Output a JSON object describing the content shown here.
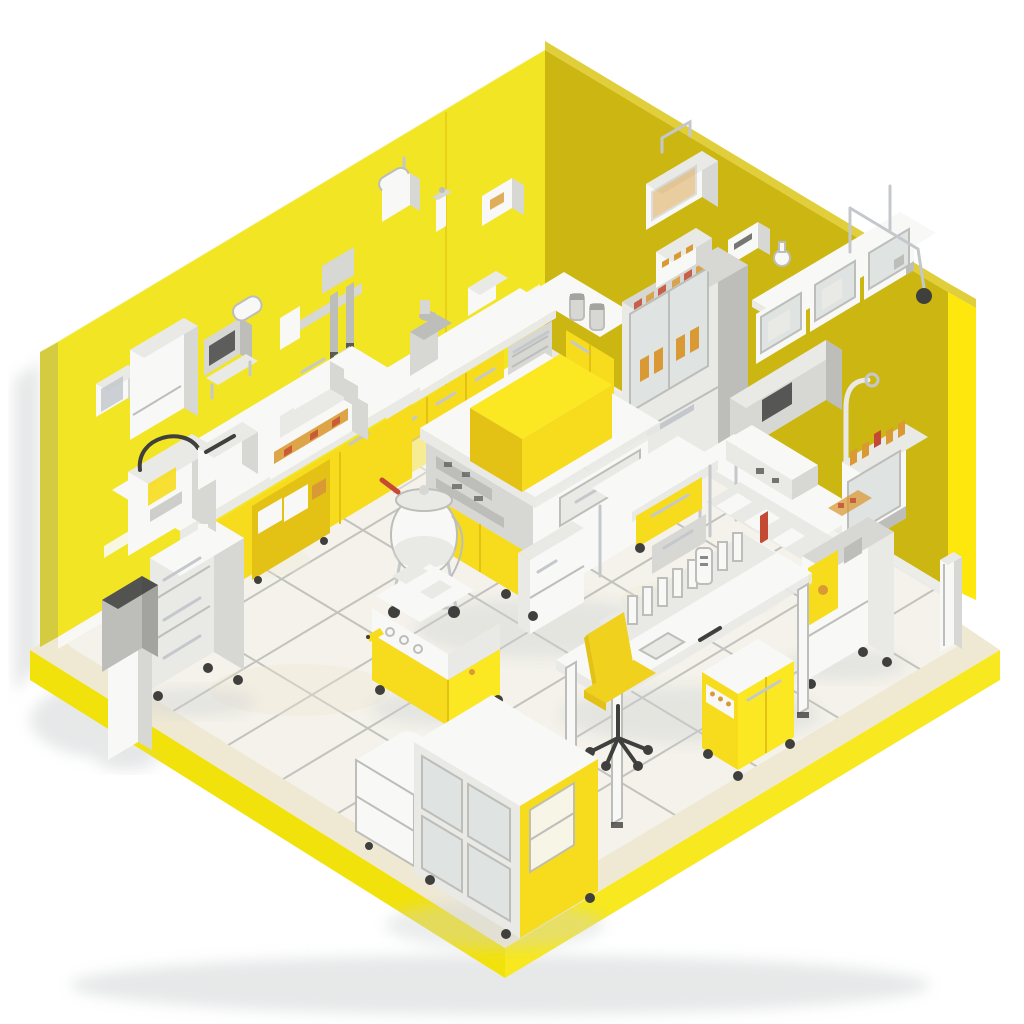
{
  "scene": {
    "type": "isometric-room-illustration",
    "subject": "laboratory",
    "description": "Isometric 3D illustration of a laboratory room with bright yellow walls, a white tiled floor on a yellow platform, and white-and-yellow laboratory furniture and equipment",
    "background": "white",
    "walls": "yellow",
    "floor": "white tile with yellow edge"
  },
  "palette": {
    "wallLeft": "#f2e524",
    "wallLeftEdge": "#d4cb40",
    "wallLeftRim": "#f7f2a8",
    "wallRight": "#ccb712",
    "wallRightRim": "#e0ce3a",
    "wallRightEnd": "#fde70d",
    "floorBorder": "#efe9d4",
    "floorTile": "#f4f2ea",
    "grout": "#dcd8cb",
    "platformLeft": "#f2e20c",
    "platformRight": "#f7e81f",
    "white1": "#f8f8f6",
    "white2": "#e9e9e5",
    "gray1": "#d7d7d3",
    "gray2": "#bdbdb9",
    "gray3": "#a3a3a0",
    "steel": "#c4c8cc",
    "glass": "#dfe4e2",
    "furnYellow": "#f7dc1e",
    "furnYellowDark": "#e3c115",
    "furnYellowLight": "#fbe822",
    "amber": "#d99a35",
    "redAccent": "#c44a33",
    "dark": "#3f3f3d",
    "chairYellow": "#f0d11d",
    "shadow": "#cfd2d3"
  },
  "objects": [
    {
      "id": "left-wall",
      "label": "bright yellow back-left wall"
    },
    {
      "id": "right-wall",
      "label": "mustard yellow back-right wall with bright end column"
    },
    {
      "id": "floor-platform",
      "label": "white tiled floor on yellow-edged platform"
    },
    {
      "id": "left-wall-items",
      "label": "wall-mounted dispensers, paper roll holders, brackets and tube rack"
    },
    {
      "id": "right-wall-items",
      "label": "wall cabinet, shelf with glass cases, flask and lab stand apparatus"
    },
    {
      "id": "corner-counter",
      "label": "L-shaped corner counter with yellow cabinets and stainless dishwasher"
    },
    {
      "id": "left-bench",
      "label": "long bench with yellow cabinets, gray drawer unit, analyzers and trash bin"
    },
    {
      "id": "fume-hood",
      "label": "fume hood display cabinet with amber reagent bottles"
    },
    {
      "id": "right-workbench",
      "label": "workbench with instruments, wall box, hutch analyzer and supply bins"
    },
    {
      "id": "floor-machine",
      "label": "floor-standing analyzer with yellow panel"
    },
    {
      "id": "pedestal-post",
      "label": "small white pedestal post"
    },
    {
      "id": "island-bench",
      "label": "central island bench with large yellow slab top and side desk"
    },
    {
      "id": "pressure-vessel-cart",
      "label": "wheeled pressure vessel with red handle"
    },
    {
      "id": "mobile-analyzer-cart",
      "label": "yellow mobile analyzer cart with gauges"
    },
    {
      "id": "sample-desk",
      "label": "white desk with rack of standing sample cassettes"
    },
    {
      "id": "office-chair",
      "label": "yellow swivel office chair on casters"
    },
    {
      "id": "desk-cart",
      "label": "yellow utility cart with control strip under desk"
    },
    {
      "id": "front-cabinet",
      "label": "mobile cabinet with glass doors and yellow side panel"
    },
    {
      "id": "floor-tool",
      "label": "small yellow tool lying on the floor"
    }
  ],
  "counts": {
    "left_wall_items": 7,
    "right_wall_items": 5,
    "floor_units": 12
  }
}
